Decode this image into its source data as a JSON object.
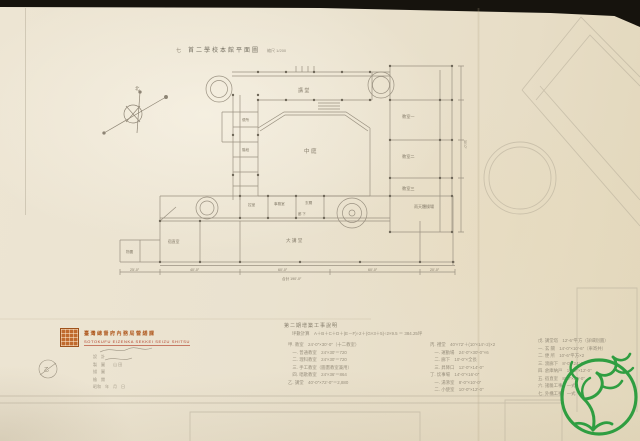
{
  "title": {
    "prefix": "七",
    "text": "首二學校本館平面圖",
    "scale": "縮尺 1/200"
  },
  "compass": {
    "north_label": "北"
  },
  "plan": {
    "labels": [
      {
        "x": 135,
        "y": 90,
        "t": "北",
        "s": 4.5
      },
      {
        "x": 298,
        "y": 92,
        "t": "講 堂",
        "s": 5
      },
      {
        "x": 304,
        "y": 153,
        "t": "中 庭",
        "s": 5.5
      },
      {
        "x": 242,
        "y": 121,
        "t": "便所",
        "s": 3.6
      },
      {
        "x": 242,
        "y": 151,
        "t": "階段",
        "s": 3.6
      },
      {
        "x": 402,
        "y": 118,
        "t": "教室一",
        "s": 4.2
      },
      {
        "x": 402,
        "y": 158,
        "t": "教室二",
        "s": 4.2
      },
      {
        "x": 402,
        "y": 190,
        "t": "教室三",
        "s": 4.2
      },
      {
        "x": 414,
        "y": 208,
        "t": "雨天體操場",
        "s": 4
      },
      {
        "x": 286,
        "y": 242,
        "t": "大 講 堂",
        "s": 4.6
      },
      {
        "x": 168,
        "y": 243,
        "t": "宿直室",
        "s": 3.8
      },
      {
        "x": 126,
        "y": 253,
        "t": "物置",
        "s": 3.6
      },
      {
        "x": 248,
        "y": 206,
        "t": "控室",
        "s": 3.6
      },
      {
        "x": 274,
        "y": 205,
        "t": "事務室",
        "s": 3.6
      },
      {
        "x": 305,
        "y": 204,
        "t": "玄關",
        "s": 3.6
      },
      {
        "x": 298,
        "y": 215,
        "t": "廊 下",
        "s": 3.4
      },
      {
        "x": 130,
        "y": 271,
        "t": "25′-0″",
        "s": 3.6
      },
      {
        "x": 190,
        "y": 271,
        "t": "40′-0″",
        "s": 3.6
      },
      {
        "x": 278,
        "y": 271,
        "t": "60′-0″",
        "s": 3.6
      },
      {
        "x": 368,
        "y": 271,
        "t": "60′-0″",
        "s": 3.6
      },
      {
        "x": 430,
        "y": 271,
        "t": "20′-0″",
        "s": 3.6
      },
      {
        "x": 282,
        "y": 280,
        "t": "合計 190′-0″",
        "s": 3.6
      },
      {
        "x": 464,
        "y": 140,
        "t": "30′-0″",
        "s": 3.4,
        "r": 90
      },
      {
        "x": 44,
        "y": 371,
        "t": "乙",
        "s": 5
      }
    ]
  },
  "stamp": {
    "line1": "臺灣總督府內務局營繕課",
    "line2": "SOTOKUFU EIZENKA SEKKEI SEIZU SHITSU",
    "rows": [
      "設　計",
      "製　圖　　山 田",
      "描　圖",
      "檢　閱",
      "昭和　年　月　日"
    ]
  },
  "legend": {
    "header": "第二期增築工事說明",
    "subheader": "坪數計算　A＋B＋C＋D＋(E－F)÷2＋(G×3＋5)÷2×9.5 ＝ 384.25坪",
    "columns": [
      {
        "x": 288,
        "y": 341,
        "items": [
          "甲. 教室　24′-0″×30′-0″（十二教室）",
          "　一. 普通教室　24′×30′＝720",
          "　二. 理科教室　24′×30′＝720",
          "　三. 手工教室（圖畫教室兼用）",
          "　四. 唱歌教室　24′×36′＝864",
          "乙. 講堂　40′-0″×72′-0″＝2,880"
        ]
      },
      {
        "x": 430,
        "y": 341,
        "items": [
          "丙. 禮堂　40′×72′＋(10′×14′÷2)×2",
          "　一. 運動場　24′-0″×30′-0″×6",
          "　二. 廊下　10′-0″×全長",
          "　三. 昇降口　12′-0″×14′-0″",
          "丁. 炊事場　14′-0″×16′-0″",
          "　一. 湯沸室　8′-0″×10′-0″",
          "　二. 小使室　10′-0″×12′-0″"
        ]
      },
      {
        "x": 538,
        "y": 337,
        "items": [
          "戊. 講堂塔　12′-6″平方（詳細別圖）",
          "一. 玄 關　14′-0″×10′-6″（車寄共）",
          "二. 便 所　10′-6″平方×2",
          "三. 渡廊下　8′-0″×24′-0″",
          "四. 倉庫納戸　10′-0″×12′-0″",
          "五. 宿直室　8′-0″×10′-0″",
          "六. 諸雜工事　一式",
          "七. 外構工事　一式"
        ]
      }
    ]
  },
  "logo": {
    "color": "#2f9e41"
  },
  "colors": {
    "paper": "#eae2cf",
    "photo_background": "#16130d",
    "pencil": "#9a9181",
    "stamp_orange": "#c06a2e",
    "stamp_red": "#b3402a"
  }
}
